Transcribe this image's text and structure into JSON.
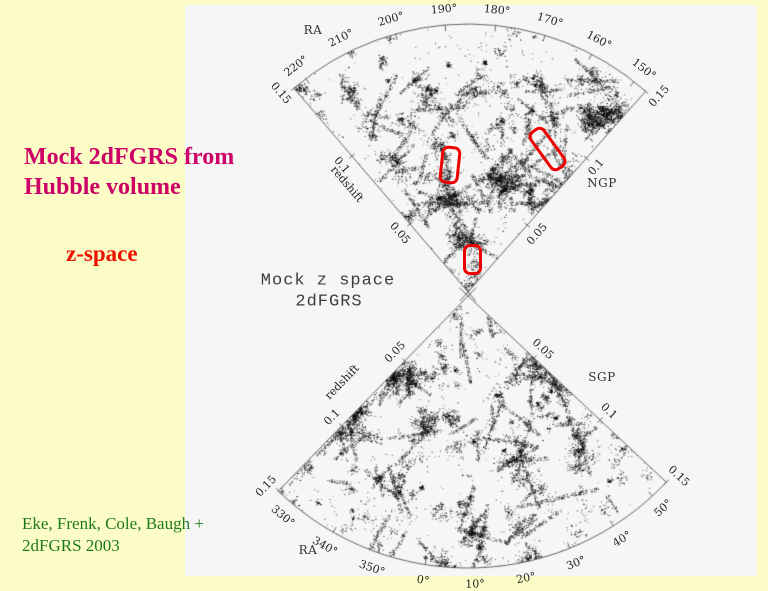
{
  "slide": {
    "background_color": "#FCFCC7",
    "plot_background_color": "#F6F6F6",
    "title_line1": "Mock 2dFGRS from",
    "title_line2": "Hubble volume",
    "title_color": "#CC0066",
    "subtitle": "z-space",
    "subtitle_color": "#EE1100",
    "credit_line1": "Eke, Frenk, Cole, Baugh +",
    "credit_line2": "2dFGRS 2003",
    "credit_color": "#1E7A1E"
  },
  "plot": {
    "center_title_line1": "Mock z space",
    "center_title_line2": "2dFGRS",
    "ra_label_top": "RA",
    "ra_label_bottom": "RA",
    "ngp_label": "NGP",
    "sgp_label": "SGP"
  },
  "chart_data": {
    "type": "scatter",
    "title": "Mock z space 2dFGRS",
    "description": "Two redshift-space cone diagrams (wedge plots) of mock 2dFGRS galaxies from the Hubble Volume simulation; each dot is one mock galaxy. Upper cone is the NGP strip (RA 150°-220°), lower cone is the SGP strip (RA 330°-50°); radial coordinate is redshift 0 to 0.15.",
    "axis_color": "#555555",
    "dot_color": "#000000",
    "highlight_color": "#EE0000",
    "wedges": [
      {
        "name": "NGP",
        "pole_label": "NGP",
        "axis_label": "redshift",
        "ra_axis_label": "RA",
        "ra_tick_labels": [
          "220°",
          "210°",
          "200°",
          "190°",
          "180°",
          "170°",
          "160°",
          "150°"
        ],
        "ra_tick_values": [
          220,
          210,
          200,
          190,
          180,
          170,
          160,
          150
        ],
        "ra_range_deg": [
          147.5,
          222.5
        ],
        "z_tick_labels": [
          "0.05",
          "0.1",
          "0.15"
        ],
        "z_tick_values": [
          0.05,
          0.1,
          0.15
        ],
        "z_range": [
          0,
          0.15
        ],
        "geometry": {
          "vertex": [
            468,
            292
          ],
          "radius": 268,
          "theta_edges": [
            48.5,
            130.5
          ],
          "map": {
            "v0": 147,
            "t0": 48.5,
            "k": 1.079
          },
          "edges": [
            {
              "theta": 130.5,
              "out": 1,
              "axis": true,
              "axis_r": 0.6,
              "axis_off": 22
            },
            {
              "theta": 48.5,
              "out": -1,
              "axis": false
            }
          ],
          "seed": 7,
          "n_attempts": 30000
        }
      },
      {
        "name": "SGP",
        "pole_label": "SGP",
        "axis_label": "redshift",
        "ra_axis_label": "RA",
        "ra_tick_labels": [
          "330°",
          "340°",
          "350°",
          "0°",
          "10°",
          "20°",
          "30°",
          "40°",
          "50°"
        ],
        "ra_tick_values": [
          330,
          340,
          350,
          360,
          370,
          380,
          390,
          400,
          410
        ],
        "ra_range_deg": [
          326,
          54
        ],
        "z_tick_labels": [
          "0.05",
          "0.1",
          "0.15"
        ],
        "z_tick_values": [
          0.05,
          0.1,
          0.15
        ],
        "z_range": [
          0,
          0.15
        ],
        "geometry": {
          "vertex": [
            468,
            296
          ],
          "radius": 272,
          "theta_edges": [
            225.8,
            316.8
          ],
          "map": {
            "v0": 326,
            "t0": 225.8,
            "k": 1.034
          },
          "edges": [
            {
              "theta": 225.8,
              "out": -1,
              "axis": true,
              "axis_r": 0.55,
              "axis_off": 30
            },
            {
              "theta": 316.8,
              "out": 1,
              "axis": false
            }
          ],
          "seed": 13,
          "n_attempts": 30000
        }
      }
    ],
    "highlight_boxes": [
      {
        "cx": 447,
        "cy": 162,
        "w": 14,
        "h": 32,
        "rot": 6
      },
      {
        "cx": 544,
        "cy": 146,
        "w": 13,
        "h": 42,
        "rot": -36
      },
      {
        "cx": 469,
        "cy": 256,
        "w": 13,
        "h": 25,
        "rot": 0
      }
    ]
  }
}
